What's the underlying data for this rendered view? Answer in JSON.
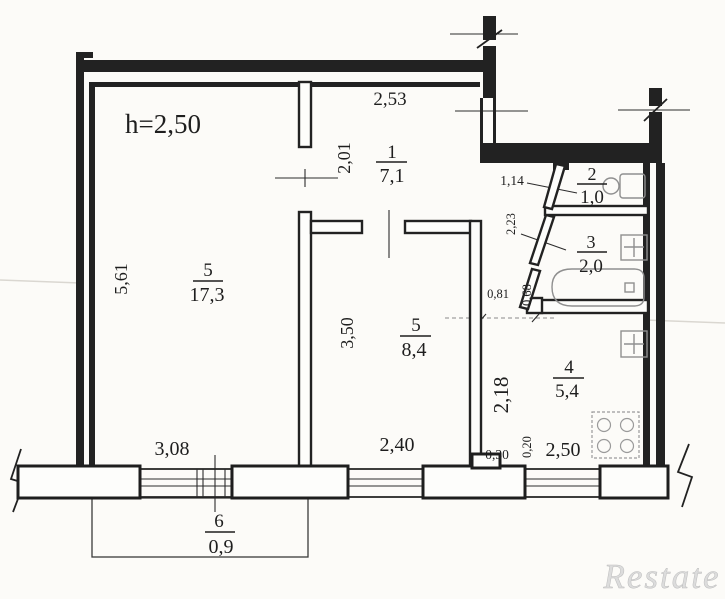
{
  "plan": {
    "ceiling_height": "h=2,50",
    "watermark": "Restate",
    "rooms": {
      "living": {
        "num": "5",
        "area": "17,3"
      },
      "hall": {
        "num": "1",
        "area": "7,1"
      },
      "wc": {
        "num": "2",
        "area": "1,0"
      },
      "bath": {
        "num": "3",
        "area": "2,0"
      },
      "room2": {
        "num": "5",
        "area": "8,4"
      },
      "kitchen": {
        "num": "4",
        "area": "5,4"
      },
      "balcony": {
        "num": "6",
        "area": "0,9"
      }
    },
    "dims": {
      "hall_width": "2,53",
      "hall_depth": "2,01",
      "living_depth": "5,61",
      "living_width": "3,08",
      "room2_depth": "3,50",
      "room2_width": "2,40",
      "wc_width": "1,14",
      "bath_wall": "2,23",
      "kitchen_door": "0,81",
      "bath_seg": "0,68",
      "kitchen_depth": "2,18",
      "pier_step_a": "0,30",
      "pier_step_b": "0,20",
      "kitchen_width": "2,50"
    },
    "colors": {
      "wall": "#222222",
      "paper": "#fcfbf8",
      "fixture": "#8f8f8f",
      "watermark": "#dcdcdc"
    }
  }
}
